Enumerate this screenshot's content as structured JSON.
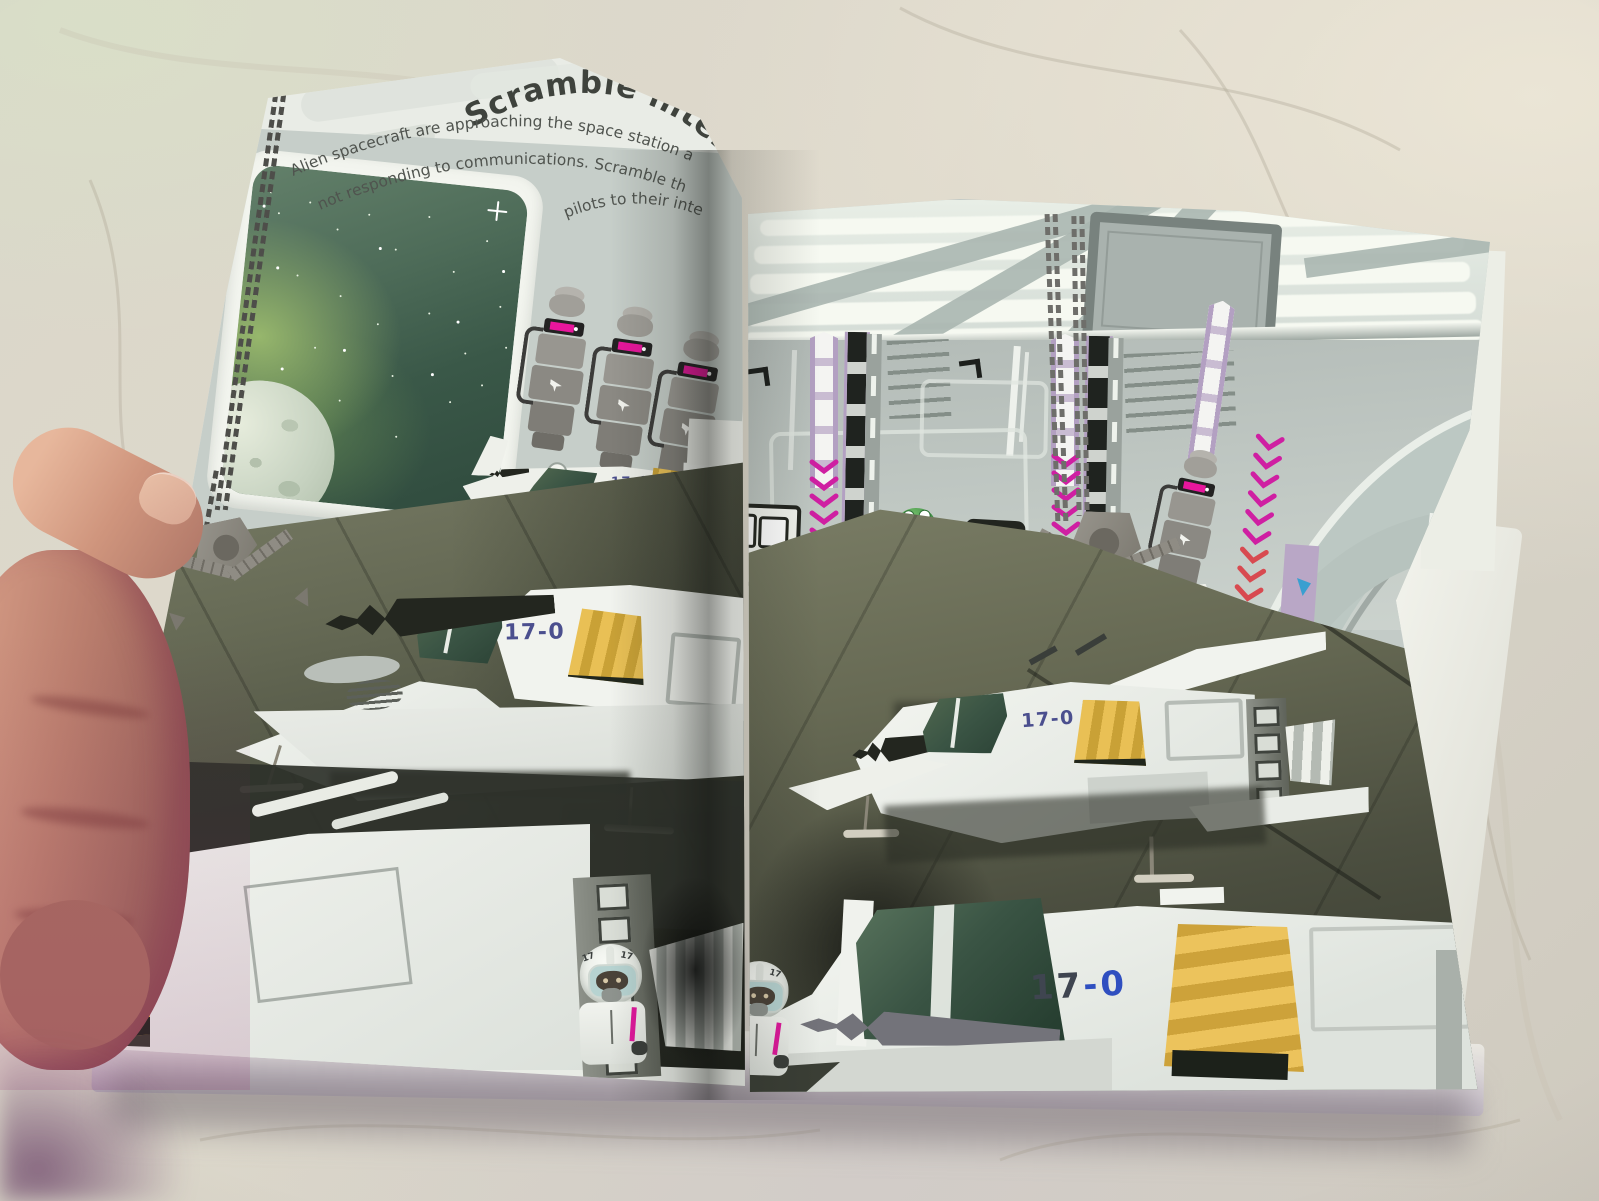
{
  "book": {
    "title_visible": "Scramble intercep",
    "intro_line1": "Alien spacecraft are approaching the space station a",
    "intro_line2": "not responding to communications. Scramble th",
    "intro_line3": "pilots to their inte"
  },
  "ship": {
    "marking": "17-0",
    "marking_prefix": "17",
    "marking_suffix": "-0"
  },
  "pilot": {
    "helmet_code": "17"
  },
  "colors": {
    "canopy_green": "#3a5444",
    "panel_yellow": "#e2b84a",
    "accent_pink": "#e0189c",
    "chevron_pink": "#cf1fa2",
    "marking_blue": "#4b4f8e",
    "marking_blue_bright": "#2f4fc0",
    "floor_olive": "#5d6150",
    "hangar_wall": "#c6cec9"
  }
}
